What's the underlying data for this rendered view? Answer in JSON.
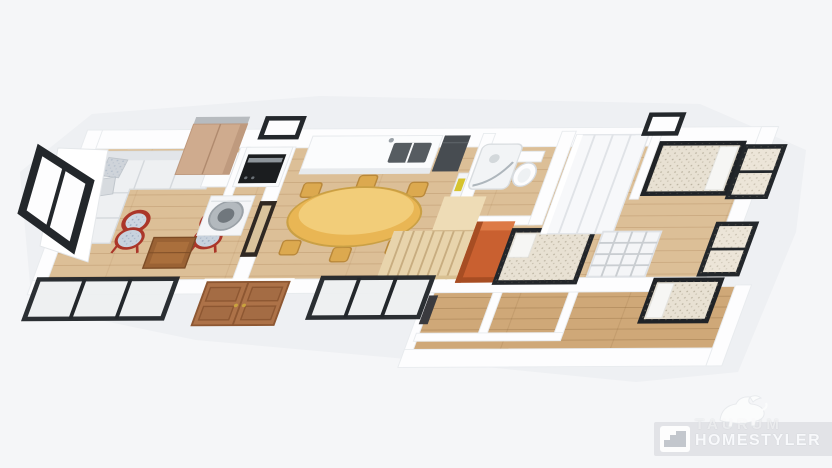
{
  "page": {
    "background_color": "#f5f6f8",
    "description": "3D isometric top-down floor plan render of a long single-storey apartment with lower annex"
  },
  "watermark": {
    "brand_line1": "TAURUM",
    "brand_line2": "HOMESTYLER",
    "mascot_icon": "bull-icon",
    "logo_icon": "steps-logo-icon",
    "band_color": "rgba(209,212,217,0.55)",
    "text_color": "#fcfdff"
  },
  "scene": {
    "view": "isometric-top-down",
    "colors": {
      "floor_wood": "#dcbf97",
      "annex_floor_wood": "#cfa878",
      "wall": "#fdfdfe",
      "window_frame": "#23272b",
      "front_door": "#ad7248",
      "stairs_wood": "#e8d4ac",
      "stair_wall_orange": "#c96030",
      "sofa": "#eef0f2",
      "armchair_red": "#ab3629",
      "dining_table_gold": "#e9b654",
      "appliance_black": "#1b1d1f",
      "mattress_beige": "#e8e1d3"
    },
    "rooms": [
      {
        "name": "living-room",
        "furniture": [
          "corner-sofa",
          "throw-pillows",
          "red-armchair",
          "red-armchair",
          "coffee-table",
          "tall-cabinet",
          "side-table"
        ]
      },
      {
        "name": "utility-nook",
        "furniture": [
          "oven-column",
          "washing-machine"
        ]
      },
      {
        "name": "kitchen-dining",
        "furniture": [
          "kitchen-counter",
          "sink",
          "fridge",
          "bottle-shelf",
          "oval-dining-table",
          "dining-chairs-x6",
          "interior-doorway"
        ]
      },
      {
        "name": "bathroom",
        "furniture": [
          "curved-shower",
          "toilet"
        ]
      },
      {
        "name": "hallway",
        "furniture": [
          "staircase",
          "orange-stair-wall",
          "front-door",
          "bed-guest"
        ]
      },
      {
        "name": "bedroom-right",
        "furniture": [
          "wardrobe",
          "double-bed",
          "cube-shelf",
          "single-bed"
        ]
      },
      {
        "name": "lower-annex",
        "furniture": [
          "empty-rooms",
          "corridor",
          "dark-doorway"
        ]
      }
    ],
    "windows": [
      "left-casement-window",
      "front-sliding-window-left",
      "front-sliding-window-center",
      "back-small-window-kitchen",
      "back-small-window-bedroom",
      "right-casement-window-upper",
      "right-casement-window-lower"
    ]
  }
}
